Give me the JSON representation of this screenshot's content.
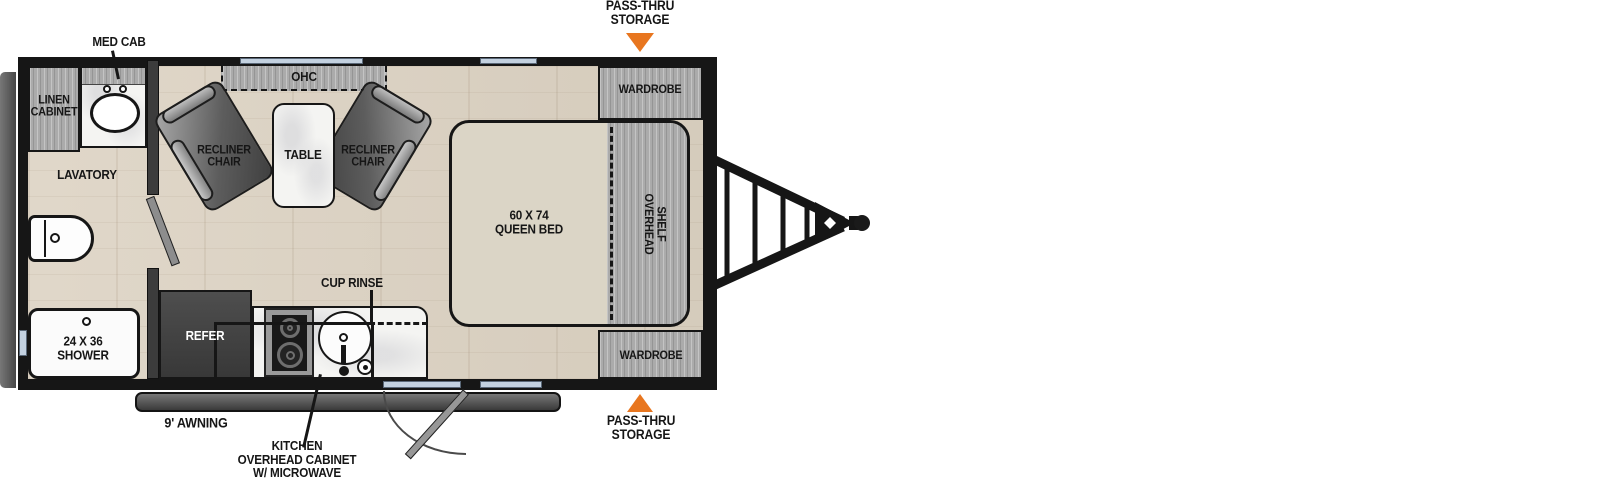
{
  "trailer": {
    "bathroom": {
      "med_cab": "MED CAB",
      "linen_cabinet": [
        "LINEN",
        "CABINET"
      ],
      "lavatory": "LAVATORY",
      "shower": [
        "24 X 36",
        "SHOWER"
      ]
    },
    "lounge": {
      "ohc": "OHC",
      "recliner_left": [
        "RECLINER",
        "CHAIR"
      ],
      "recliner_right": [
        "RECLINER",
        "CHAIR"
      ],
      "table": "TABLE"
    },
    "bedroom": {
      "queen_bed": [
        "60 X 74",
        "QUEEN BED"
      ],
      "wardrobe_top": "WARDROBE",
      "wardrobe_bottom": "WARDROBE",
      "overhead_shelf": [
        "OVERHEAD",
        "SHELF"
      ]
    },
    "kitchen": {
      "refer": "REFER",
      "cup_rinse": "CUP RINSE",
      "overhead_cabinet": [
        "KITCHEN",
        "OVERHEAD CABINET",
        "W/ MICROWAVE"
      ]
    },
    "exterior": {
      "pass_thru_top": [
        "PASS-THRU",
        "STORAGE"
      ],
      "pass_thru_bottom": [
        "PASS-THRU",
        "STORAGE"
      ],
      "awning": "9' AWNING"
    },
    "colors": {
      "accent_orange": "#E8761F",
      "window_blue": "#C3D1E0",
      "wall": "#161616",
      "floor": "#DCD2C2",
      "cabinet_gray": "#ABABAB",
      "bed": "#DBD5C6"
    }
  }
}
